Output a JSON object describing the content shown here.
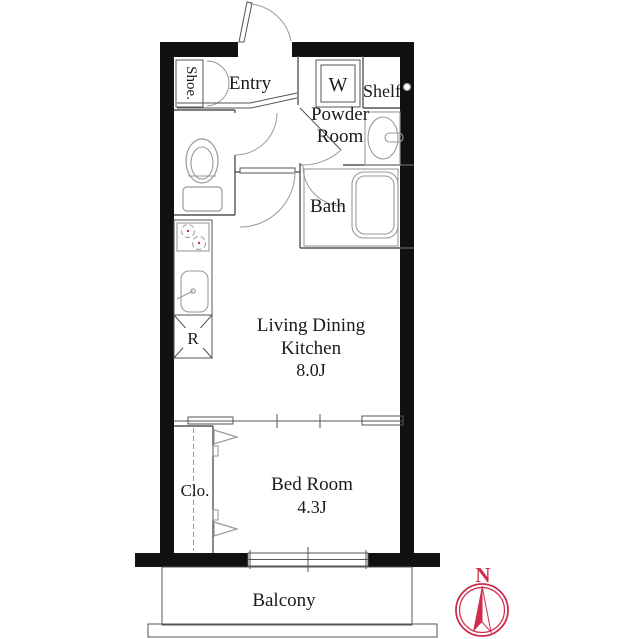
{
  "labels": {
    "shoe": "Shoe.",
    "entry": "Entry",
    "washer": "W",
    "shelf": "Shelf",
    "powder1": "Powder",
    "powder2": "Room",
    "bath": "Bath",
    "ldk1": "Living Dining",
    "ldk2": "Kitchen",
    "ldk_size": "8.0J",
    "fridge": "R",
    "closet": "Clo.",
    "bedroom": "Bed Room",
    "bedroom_size": "4.3J",
    "balcony": "Balcony",
    "compass_north": "N"
  },
  "colors": {
    "wall": "#111111",
    "partition": "#555555",
    "fixture": "#999999",
    "text": "#1a1a1a",
    "compass": "#cf2b4b",
    "background": "#ffffff"
  }
}
